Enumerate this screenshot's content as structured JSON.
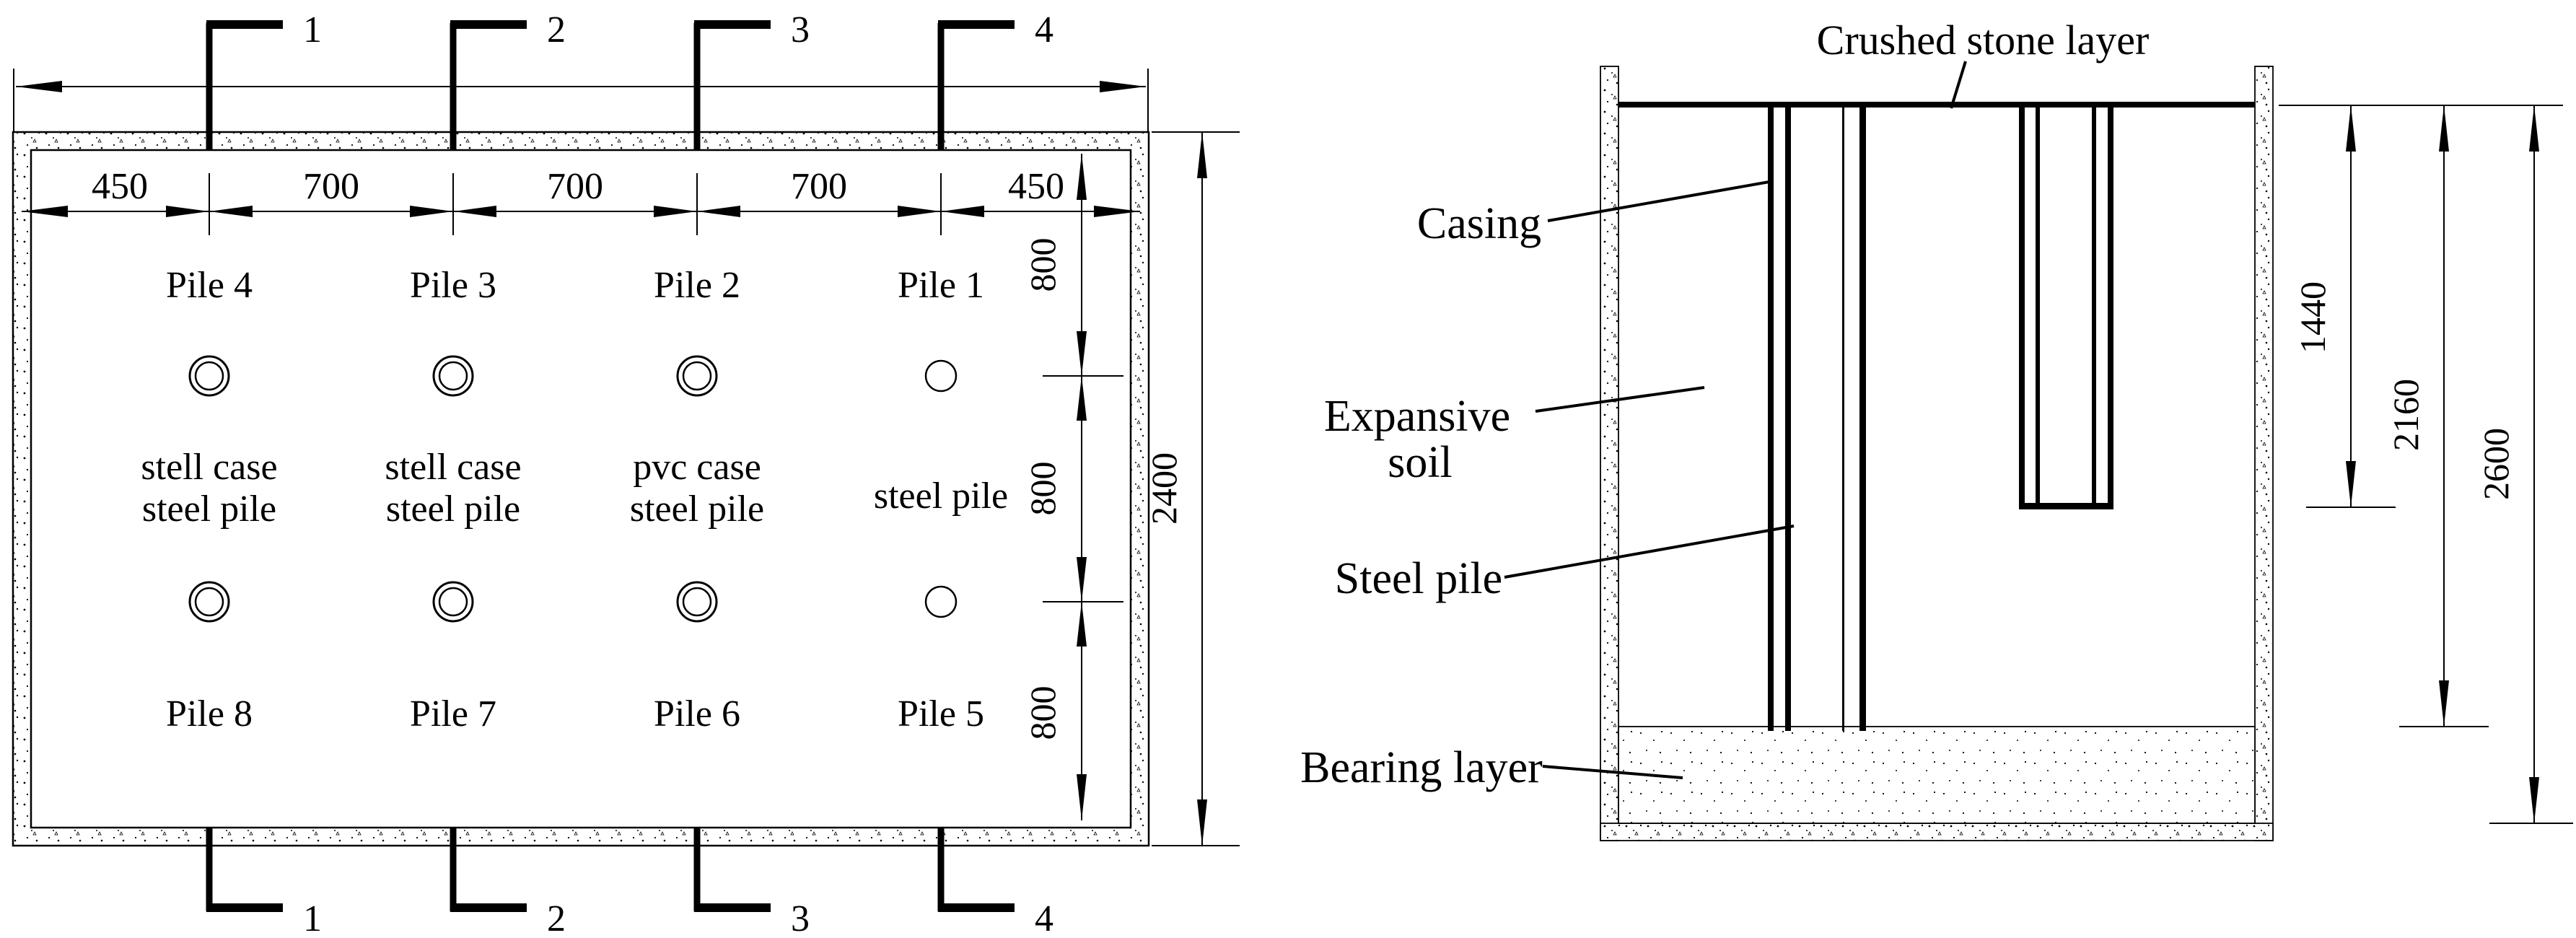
{
  "plan": {
    "markers_top": [
      "1",
      "2",
      "3",
      "4"
    ],
    "markers_bottom": [
      "1",
      "2",
      "3",
      "4"
    ],
    "h_dims": [
      "450",
      "700",
      "700",
      "700",
      "450"
    ],
    "v_dims": [
      "800",
      "800",
      "800"
    ],
    "overall_dim": "2400",
    "piles_top": [
      "Pile 4",
      "Pile 3",
      "Pile 2",
      "Pile 1"
    ],
    "piles_bottom": [
      "Pile 8",
      "Pile 7",
      "Pile 6",
      "Pile 5"
    ],
    "case_col1_l1": "stell case",
    "case_col1_l2": "steel pile",
    "case_col2_l1": "stell case",
    "case_col2_l2": "steel pile",
    "case_col3_l1": "pvc case",
    "case_col3_l2": "steel pile",
    "case_col4": "steel pile"
  },
  "section": {
    "labels": {
      "crushed_stone": "Crushed stone layer",
      "casing": "Casing",
      "expansive_line1": "Expansive",
      "expansive_line2": "soil",
      "steel_pile": "Steel pile",
      "bearing_layer": "Bearing layer"
    },
    "depth_dims": [
      "1440",
      "2160",
      "2600"
    ]
  }
}
